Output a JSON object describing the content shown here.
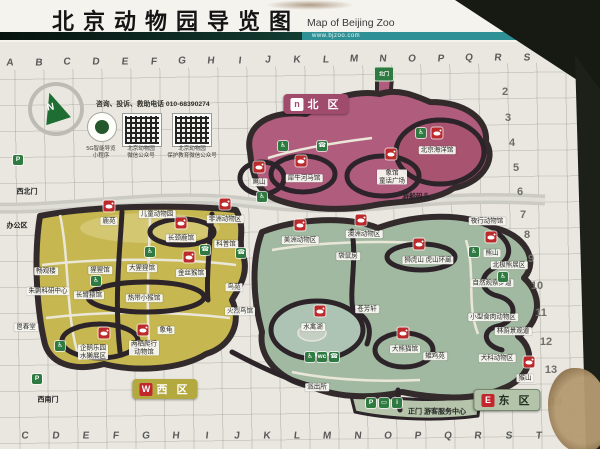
{
  "header": {
    "title": "北京动物园导览图",
    "title_en": "Map of Beijing Zoo",
    "website": "www.bjzoo.com"
  },
  "info_panel": {
    "hotline": "咨询、投诉、救助电话 010-68390274",
    "compass": "N",
    "mini_program": [
      "5G智能导览",
      "小程序"
    ],
    "qr_codes": [
      [
        "北京动物园",
        "微信公众号"
      ],
      [
        "北京动物园",
        "保护教育微信公众号"
      ]
    ]
  },
  "zones": [
    {
      "name": "north",
      "letter": "n",
      "label": "北 区",
      "color": "#b05c7d"
    },
    {
      "name": "west",
      "letter": "W",
      "label": "西 区",
      "color": "#c6b750"
    },
    {
      "name": "east",
      "letter": "E",
      "label": "东 区",
      "color": "#a2b9a1"
    }
  ],
  "grid": {
    "columns": [
      "A",
      "B",
      "C",
      "D",
      "E",
      "F",
      "G",
      "H",
      "I",
      "J",
      "K",
      "L",
      "M",
      "N",
      "O",
      "P",
      "Q",
      "R",
      "S",
      "T"
    ],
    "row_numbers": [
      {
        "n": "2",
        "x": 505,
        "y": 92
      },
      {
        "n": "3",
        "x": 508,
        "y": 118
      },
      {
        "n": "4",
        "x": 512,
        "y": 143
      },
      {
        "n": "5",
        "x": 516,
        "y": 168
      },
      {
        "n": "6",
        "x": 520,
        "y": 192
      },
      {
        "n": "7",
        "x": 523,
        "y": 215
      },
      {
        "n": "8",
        "x": 527,
        "y": 235
      },
      {
        "n": "9",
        "x": 531,
        "y": 259
      },
      {
        "n": "10",
        "x": 537,
        "y": 286
      },
      {
        "n": "11",
        "x": 541,
        "y": 313
      },
      {
        "n": "12",
        "x": 546,
        "y": 342
      },
      {
        "n": "13",
        "x": 551,
        "y": 370
      },
      {
        "n": "14",
        "x": 556,
        "y": 402
      }
    ]
  },
  "features": [
    {
      "name": "northwest-gate-label",
      "lines": [
        "西北门"
      ],
      "x": 27,
      "y": 192,
      "plain": true
    },
    {
      "name": "northwest-gate-parking",
      "x": 18,
      "y": 160,
      "icon": {
        "name": "parking-icon",
        "color": "green",
        "glyph": "P"
      }
    },
    {
      "name": "office-area-label",
      "lines": [
        "办公区"
      ],
      "x": 17,
      "y": 226,
      "plain": true
    },
    {
      "name": "changguan-tower-label",
      "lines": [
        "畅观楼"
      ],
      "x": 46,
      "y": 271
    },
    {
      "name": "ibis-research-center-label",
      "lines": [
        "朱鹮科研中心"
      ],
      "x": 48,
      "y": 291
    },
    {
      "name": "changchun-hall-label",
      "lines": [
        "鬯春堂"
      ],
      "x": 26,
      "y": 327
    },
    {
      "name": "southwest-gate-label",
      "lines": [
        "西南门"
      ],
      "x": 48,
      "y": 400,
      "plain": true
    },
    {
      "name": "southwest-gate-parking",
      "x": 37,
      "y": 379,
      "icon": {
        "name": "parking-icon",
        "color": "green",
        "glyph": "P"
      }
    },
    {
      "name": "deer-garden-icon",
      "x": 109,
      "y": 206,
      "icon": {
        "name": "deer-icon",
        "color": "red"
      }
    },
    {
      "name": "deer-garden-label",
      "lines": [
        "鹿苑"
      ],
      "x": 109,
      "y": 221
    },
    {
      "name": "children-zoo-label",
      "lines": [
        "儿童动物园"
      ],
      "x": 157,
      "y": 214
    },
    {
      "name": "africa-animals-icon",
      "x": 225,
      "y": 204,
      "icon": {
        "name": "zebra-icon",
        "color": "red"
      }
    },
    {
      "name": "africa-animals-label",
      "lines": [
        "非洲动物区"
      ],
      "x": 225,
      "y": 219
    },
    {
      "name": "giraffe-house-icon",
      "x": 181,
      "y": 223,
      "icon": {
        "name": "giraffe-icon",
        "color": "red"
      }
    },
    {
      "name": "giraffe-house-label",
      "lines": [
        "长颈鹿馆"
      ],
      "x": 181,
      "y": 238
    },
    {
      "name": "science-hall-label",
      "lines": [
        "科普馆"
      ],
      "x": 226,
      "y": 244
    },
    {
      "name": "orangutan-house-label",
      "lines": [
        "猩猩馆"
      ],
      "x": 100,
      "y": 270
    },
    {
      "name": "gorilla-house-label",
      "lines": [
        "大猩猩馆"
      ],
      "x": 142,
      "y": 268
    },
    {
      "name": "golden-monkey-house-icon",
      "x": 189,
      "y": 257,
      "icon": {
        "name": "monkey-icon",
        "color": "red"
      }
    },
    {
      "name": "golden-monkey-house-label",
      "lines": [
        "金丝猴馆"
      ],
      "x": 191,
      "y": 273
    },
    {
      "name": "gibbon-house-label",
      "lines": [
        "长臂猿馆"
      ],
      "x": 89,
      "y": 295
    },
    {
      "name": "tropical-monkey-house-label",
      "lines": [
        "热带小猴馆"
      ],
      "x": 144,
      "y": 298
    },
    {
      "name": "penguin-park-icon",
      "x": 104,
      "y": 333,
      "icon": {
        "name": "penguin-icon",
        "color": "red"
      }
    },
    {
      "name": "penguin-park-label",
      "lines": [
        "企鹅乐园",
        "水獭展区"
      ],
      "x": 93,
      "y": 352
    },
    {
      "name": "reptile-house-icon",
      "x": 143,
      "y": 330,
      "icon": {
        "name": "crocodile-icon",
        "color": "red"
      }
    },
    {
      "name": "reptile-house-label",
      "lines": [
        "两栖爬行",
        "动物馆"
      ],
      "x": 144,
      "y": 348
    },
    {
      "name": "tortoise-label",
      "lines": [
        "象龟"
      ],
      "x": 166,
      "y": 330
    },
    {
      "name": "bird-garden-label",
      "lines": [
        "鸟苑"
      ],
      "x": 234,
      "y": 287
    },
    {
      "name": "flamingo-house-label",
      "lines": [
        "火烈鸟馆"
      ],
      "x": 240,
      "y": 311
    },
    {
      "name": "eagle-hill-icon",
      "x": 259,
      "y": 167,
      "icon": {
        "name": "eagle-icon",
        "color": "red"
      }
    },
    {
      "name": "eagle-hill-label",
      "lines": [
        "鹰山"
      ],
      "x": 259,
      "y": 182
    },
    {
      "name": "rhino-hippo-house-icon",
      "x": 301,
      "y": 161,
      "icon": {
        "name": "rhino-icon",
        "color": "red"
      }
    },
    {
      "name": "rhino-hippo-house-label",
      "lines": [
        "犀牛河马馆"
      ],
      "x": 304,
      "y": 178
    },
    {
      "name": "elephant-house-icon",
      "x": 391,
      "y": 154,
      "icon": {
        "name": "elephant-icon",
        "color": "red"
      }
    },
    {
      "name": "elephant-house-label",
      "lines": [
        "象馆",
        "童话广场"
      ],
      "x": 392,
      "y": 177
    },
    {
      "name": "aquarium-icon",
      "x": 437,
      "y": 133,
      "icon": {
        "name": "seal-icon",
        "color": "red"
      }
    },
    {
      "name": "aquarium-label",
      "lines": [
        "北京海洋馆"
      ],
      "x": 437,
      "y": 150
    },
    {
      "name": "boat-dock-label",
      "lines": [
        "游船码头"
      ],
      "x": 416,
      "y": 197,
      "plain": true
    },
    {
      "name": "north-gate-marker",
      "x": 384,
      "y": 74,
      "icon": {
        "name": "north-gate-icon",
        "color": "gate",
        "glyph": "北门"
      }
    },
    {
      "name": "america-animals-icon",
      "x": 300,
      "y": 225,
      "icon": {
        "name": "llama-icon",
        "color": "red"
      }
    },
    {
      "name": "america-animals-label",
      "lines": [
        "美洲动物区"
      ],
      "x": 300,
      "y": 240
    },
    {
      "name": "australia-animals-icon",
      "x": 361,
      "y": 220,
      "icon": {
        "name": "kangaroo-icon",
        "color": "red"
      }
    },
    {
      "name": "australia-animals-label",
      "lines": [
        "澳洲动物区"
      ],
      "x": 364,
      "y": 234
    },
    {
      "name": "kangaroo-house-label",
      "lines": [
        "袋鼠房"
      ],
      "x": 348,
      "y": 256
    },
    {
      "name": "lion-tiger-hill-icon",
      "x": 419,
      "y": 244,
      "icon": {
        "name": "tiger-icon",
        "color": "red"
      }
    },
    {
      "name": "lion-tiger-hill-label",
      "lines": [
        "狮虎山 虎山环廊"
      ],
      "x": 428,
      "y": 260
    },
    {
      "name": "night-animal-house-label",
      "lines": [
        "夜行动物馆"
      ],
      "x": 487,
      "y": 221
    },
    {
      "name": "bear-hill-icon",
      "x": 491,
      "y": 237,
      "icon": {
        "name": "bear-icon",
        "color": "red"
      }
    },
    {
      "name": "bear-hill-label",
      "lines": [
        "熊山"
      ],
      "x": 492,
      "y": 253
    },
    {
      "name": "polar-bear-area-label",
      "lines": [
        "北极熊展区"
      ],
      "x": 509,
      "y": 265
    },
    {
      "name": "nature-trail-label",
      "lines": [
        "自然观察步道"
      ],
      "x": 492,
      "y": 283
    },
    {
      "name": "cangfang-pavilion-label",
      "lines": [
        "苍芳轩"
      ],
      "x": 367,
      "y": 309
    },
    {
      "name": "waterfowl-lake-icon",
      "x": 320,
      "y": 311,
      "icon": {
        "name": "crane-icon",
        "color": "red"
      }
    },
    {
      "name": "waterfowl-lake-label",
      "lines": [
        "水禽湖"
      ],
      "x": 313,
      "y": 327
    },
    {
      "name": "panda-house-icon",
      "x": 403,
      "y": 333,
      "icon": {
        "name": "panda-icon",
        "color": "red"
      }
    },
    {
      "name": "panda-house-label",
      "lines": [
        "大熊猫馆"
      ],
      "x": 405,
      "y": 349
    },
    {
      "name": "pheasant-garden-label",
      "lines": [
        "雉鸡苑"
      ],
      "x": 435,
      "y": 356
    },
    {
      "name": "small-carnivore-area-label",
      "lines": [
        "小型食肉动物区"
      ],
      "x": 493,
      "y": 317
    },
    {
      "name": "shaded-scenic-path-label",
      "lines": [
        "林荫景观道"
      ],
      "x": 513,
      "y": 331
    },
    {
      "name": "canine-area-label",
      "lines": [
        "犬科动物区"
      ],
      "x": 497,
      "y": 358
    },
    {
      "name": "monkey-hill-icon",
      "x": 529,
      "y": 362,
      "icon": {
        "name": "monkey-icon",
        "color": "red"
      }
    },
    {
      "name": "monkey-hill-label",
      "lines": [
        "猴山"
      ],
      "x": 525,
      "y": 378
    },
    {
      "name": "police-station-label",
      "lines": [
        "派出所"
      ],
      "x": 317,
      "y": 387
    },
    {
      "name": "main-gate-parking",
      "x": 371,
      "y": 403,
      "icon": {
        "name": "parking-icon",
        "color": "green",
        "glyph": "P"
      }
    },
    {
      "name": "main-gate-bus",
      "x": 384,
      "y": 403,
      "icon": {
        "name": "bus-icon",
        "color": "green",
        "glyph": "▭"
      }
    },
    {
      "name": "main-gate-info",
      "x": 397,
      "y": 403,
      "icon": {
        "name": "info-icon",
        "color": "green",
        "glyph": "i"
      }
    },
    {
      "name": "main-gate-label",
      "lines": [
        "正门 游客服务中心"
      ],
      "x": 437,
      "y": 412,
      "plain": true
    },
    {
      "name": "facility-wheelchair-1",
      "x": 421,
      "y": 133,
      "icon": {
        "name": "wheelchair-icon",
        "color": "green",
        "glyph": "♿"
      }
    },
    {
      "name": "facility-wheelchair-2",
      "x": 283,
      "y": 146,
      "icon": {
        "name": "wheelchair-icon",
        "color": "green",
        "glyph": "♿"
      }
    },
    {
      "name": "facility-phone-1",
      "x": 322,
      "y": 146,
      "icon": {
        "name": "phone-icon",
        "color": "green",
        "glyph": "☎"
      }
    },
    {
      "name": "facility-wheelchair-3",
      "x": 262,
      "y": 197,
      "icon": {
        "name": "wheelchair-icon",
        "color": "green",
        "glyph": "♿"
      }
    },
    {
      "name": "facility-phone-2",
      "x": 241,
      "y": 253,
      "icon": {
        "name": "phone-icon",
        "color": "green",
        "glyph": "☎"
      }
    },
    {
      "name": "facility-wheelchair-4",
      "x": 150,
      "y": 252,
      "icon": {
        "name": "wheelchair-icon",
        "color": "green",
        "glyph": "♿"
      }
    },
    {
      "name": "facility-phone-3",
      "x": 205,
      "y": 250,
      "icon": {
        "name": "phone-icon",
        "color": "green",
        "glyph": "☎"
      }
    },
    {
      "name": "facility-wheelchair-5",
      "x": 96,
      "y": 281,
      "icon": {
        "name": "wheelchair-icon",
        "color": "green",
        "glyph": "♿"
      }
    },
    {
      "name": "facility-wheelchair-6",
      "x": 60,
      "y": 346,
      "icon": {
        "name": "wheelchair-icon",
        "color": "green",
        "glyph": "♿"
      }
    },
    {
      "name": "facility-wheelchair-7",
      "x": 310,
      "y": 357,
      "icon": {
        "name": "wheelchair-icon",
        "color": "green",
        "glyph": "♿"
      }
    },
    {
      "name": "facility-toilet-1",
      "x": 322,
      "y": 357,
      "icon": {
        "name": "toilet-icon",
        "color": "green",
        "glyph": "wc"
      }
    },
    {
      "name": "facility-phone-4",
      "x": 334,
      "y": 357,
      "icon": {
        "name": "phone-icon",
        "color": "green",
        "glyph": "☎"
      }
    },
    {
      "name": "facility-wheelchair-8",
      "x": 474,
      "y": 252,
      "icon": {
        "name": "wheelchair-icon",
        "color": "green",
        "glyph": "♿"
      }
    },
    {
      "name": "facility-wheelchair-9",
      "x": 503,
      "y": 277,
      "icon": {
        "name": "wheelchair-icon",
        "color": "green",
        "glyph": "♿"
      }
    }
  ]
}
